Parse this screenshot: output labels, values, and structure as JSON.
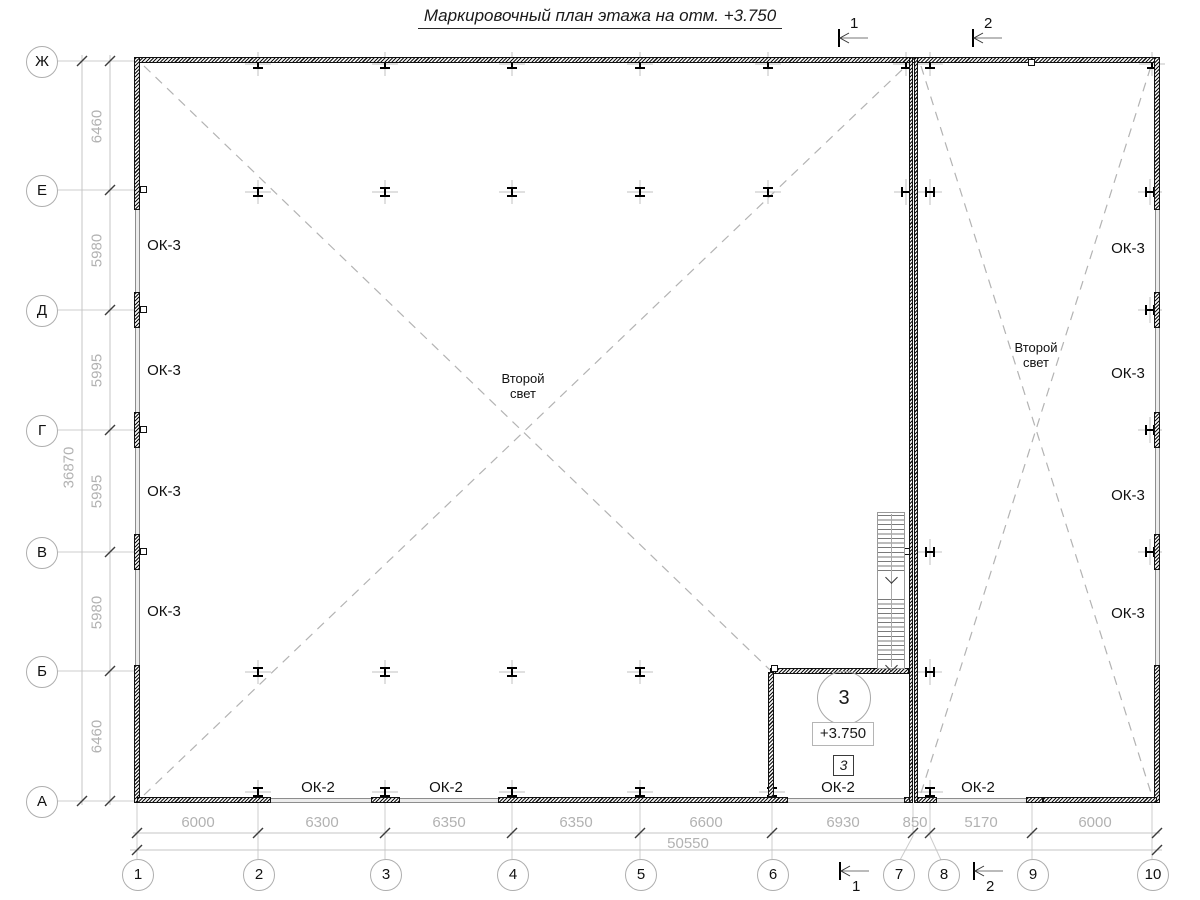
{
  "title": "Маркировочный план этажа на отм. +3.750",
  "grid": {
    "rows": [
      "Ж",
      "Е",
      "Д",
      "Г",
      "В",
      "Б",
      "А"
    ],
    "cols": [
      "1",
      "2",
      "3",
      "4",
      "5",
      "6",
      "7",
      "8",
      "9",
      "10"
    ]
  },
  "dimensions": {
    "left": [
      "6460",
      "5980",
      "5995",
      "5995",
      "5980",
      "6460"
    ],
    "left_total": "36870",
    "bottom": [
      "6000",
      "6300",
      "6350",
      "6350",
      "6600",
      "6930",
      "850",
      "5170",
      "6000"
    ],
    "bottom_total": "50550"
  },
  "sections": {
    "top": [
      "1",
      "2"
    ],
    "bottom": [
      "1",
      "2"
    ]
  },
  "windows": {
    "ok3": "ОК-3",
    "ok2": "ОК-2"
  },
  "void_label": {
    "line1": "Второй",
    "line2": "свет"
  },
  "room": {
    "number": "3",
    "elevation": "+3.750",
    "type_mark": "3"
  },
  "colors": {
    "ink": "#1a1a1a",
    "dim_text": "#b2b2b2",
    "line_gray": "#c9c9c9",
    "dash_gray": "#b3b3b3"
  }
}
